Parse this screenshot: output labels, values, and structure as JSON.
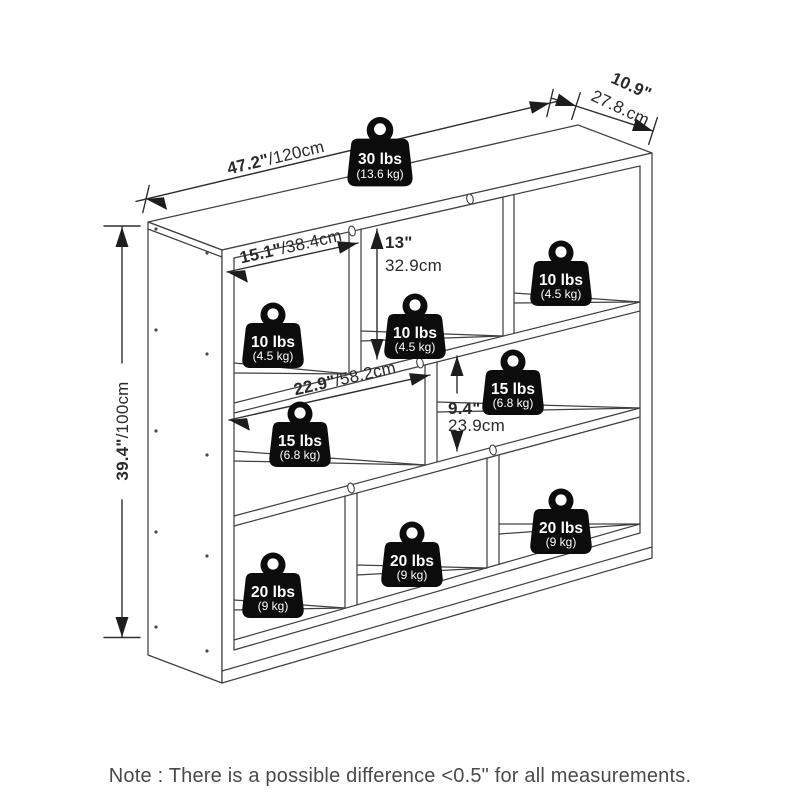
{
  "note": {
    "text": "Note : There is a possible difference <0.5\" for all measurements."
  },
  "colors": {
    "line": "#414141",
    "dimension_text": "#2a2a2a",
    "weight_fill": "#0c0c0c",
    "weight_text": "#ffffff",
    "note_text": "#4a4a4a",
    "background": "#ffffff"
  },
  "dimensions": {
    "overall_width": {
      "inches": "47.2\"",
      "metric": "/120cm"
    },
    "depth": {
      "inches": "10.9\"",
      "metric": "27.8.cm"
    },
    "overall_height": {
      "inches": "39.4\"",
      "metric": "/100cm"
    },
    "cube_width": {
      "inches": "15.1\"",
      "metric": "/38.4cm"
    },
    "cube_height": {
      "inches": "13\"",
      "metric": "32.9cm"
    },
    "wide_cube_width": {
      "inches": "22.9\"",
      "metric": "/58.2cm"
    },
    "middle_cube_height": {
      "inches": "9.4\"",
      "metric": "23.9cm"
    }
  },
  "weights": [
    {
      "position": "top-surface",
      "lbs": "30 lbs",
      "kg": "(13.6 kg)"
    },
    {
      "position": "top-row-left",
      "lbs": "10 lbs",
      "kg": "(4.5 kg)"
    },
    {
      "position": "top-row-middle",
      "lbs": "10 lbs",
      "kg": "(4.5 kg)"
    },
    {
      "position": "top-row-right",
      "lbs": "10 lbs",
      "kg": "(4.5 kg)"
    },
    {
      "position": "middle-row-wide",
      "lbs": "15 lbs",
      "kg": "(6.8 kg)"
    },
    {
      "position": "middle-row-right",
      "lbs": "15 lbs",
      "kg": "(6.8 kg)"
    },
    {
      "position": "bottom-row-left",
      "lbs": "20 lbs",
      "kg": "(9 kg)"
    },
    {
      "position": "bottom-row-middle",
      "lbs": "20 lbs",
      "kg": "(9 kg)"
    },
    {
      "position": "bottom-row-right",
      "lbs": "20 lbs",
      "kg": "(9 kg)"
    }
  ]
}
